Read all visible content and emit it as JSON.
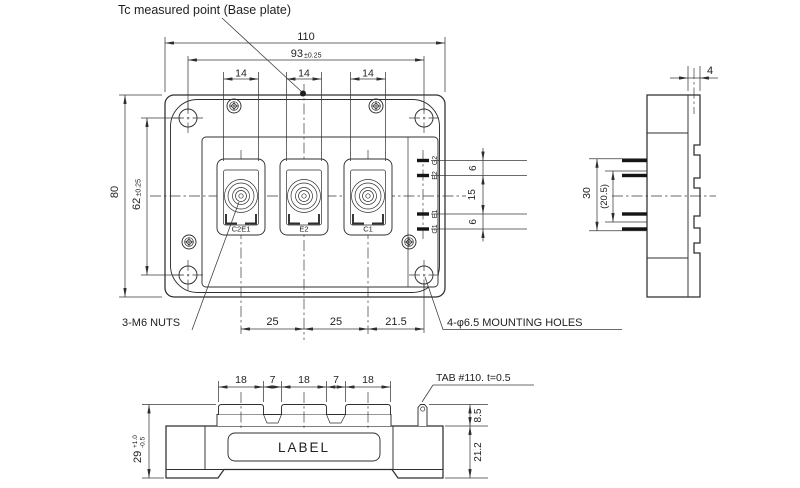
{
  "colors": {
    "background": "#ffffff",
    "ink": "#2f2f2f"
  },
  "drawing": {
    "note_tc": "Tc measured point  (Base plate)",
    "front": {
      "dim_110": "110",
      "dim_93": "93",
      "tol_93": "±0.25",
      "dim_14": "14",
      "dim_80": "80",
      "dim_62": "62",
      "tol_62": "±0.25",
      "dim_6": "6",
      "dim_15": "15",
      "dim_25": "25",
      "dim_21_5": "21.5",
      "terminal_labels": [
        "C2E1",
        "E2",
        "C1"
      ],
      "pin_labels": [
        "G2",
        "E2",
        "E1",
        "G1"
      ],
      "note_nuts": "3-M6 NUTS",
      "note_mounting": "4-φ6.5 MOUNTING HOLES"
    },
    "side": {
      "dim_4": "4",
      "dim_30": "30",
      "dim_20_5": "(20.5)"
    },
    "bottom": {
      "dim_18": "18",
      "dim_7": "7",
      "note_tab": "TAB #110. t=0.5",
      "label": "LABEL",
      "dim_29": "29",
      "tol_29_plus": "+1.0",
      "tol_29_minus": "-0.5",
      "dim_8_5": "8.5",
      "dim_21_2": "21.2"
    }
  }
}
